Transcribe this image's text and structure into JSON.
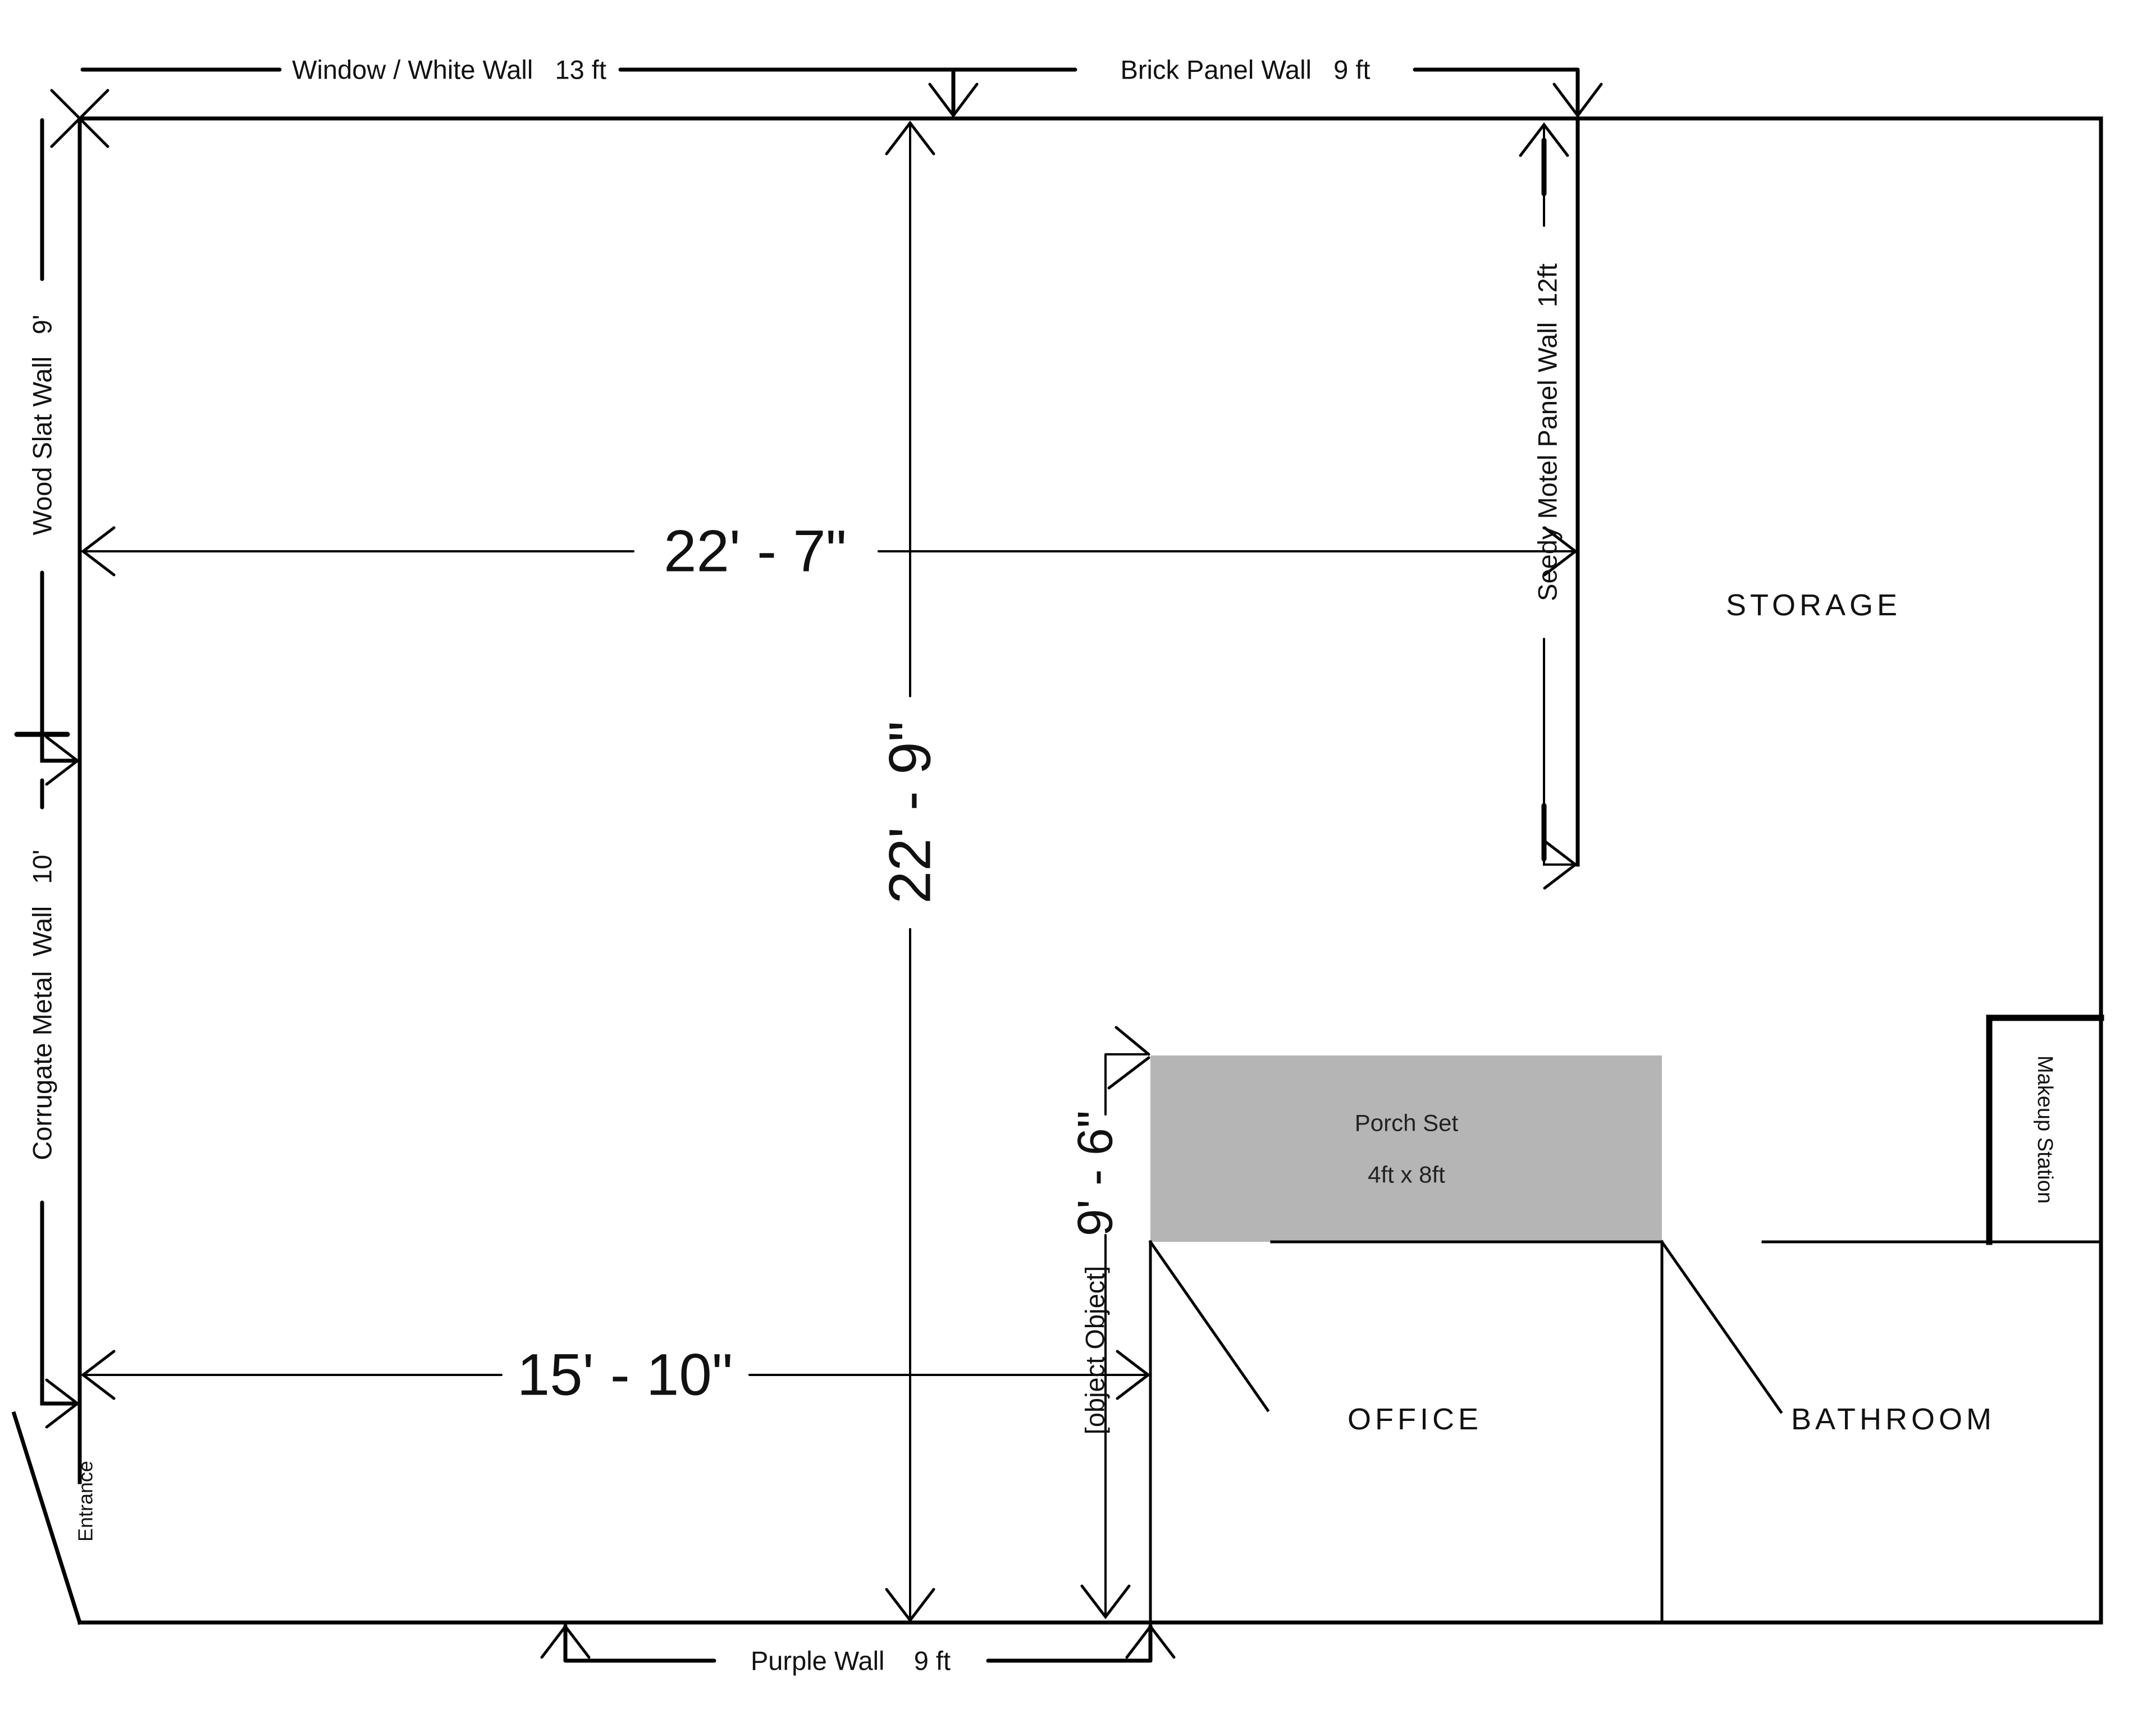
{
  "walls": {
    "window_white": {
      "label": "Window / White Wall   13 ft"
    },
    "brick_panel": {
      "label": "Brick Panel Wall   9 ft"
    },
    "wood_slat": {
      "label": "Wood Slat Wall   9'"
    },
    "corrugate_metal": {
      "label": "Corrugate Metal  Wall   10'"
    },
    "seedy_motel": {
      "label": "Seedy Motel Panel Wall  12ft"
    },
    "purple": {
      "label": "Purple Wall    9 ft"
    },
    "gray": {
      "label": "Gray Wall"
    }
  },
  "dimensions": {
    "width_upper": "22' - 7\"",
    "height_center": "22' - 9\"",
    "width_lower": "15' - 10\"",
    "gray_wall_height": "9' - 6\""
  },
  "rooms": {
    "storage": "STORAGE",
    "office": "OFFICE",
    "bathroom": "BATHROOM"
  },
  "features": {
    "porch": {
      "line1": "Porch Set",
      "line2": "4ft x 8ft"
    },
    "makeup_station": "Makeup Station",
    "entrance": "Entrance"
  },
  "colors": {
    "wall": "#000000",
    "porch_fill": "#b5b5b5",
    "text": "#111111",
    "background": "#ffffff"
  }
}
